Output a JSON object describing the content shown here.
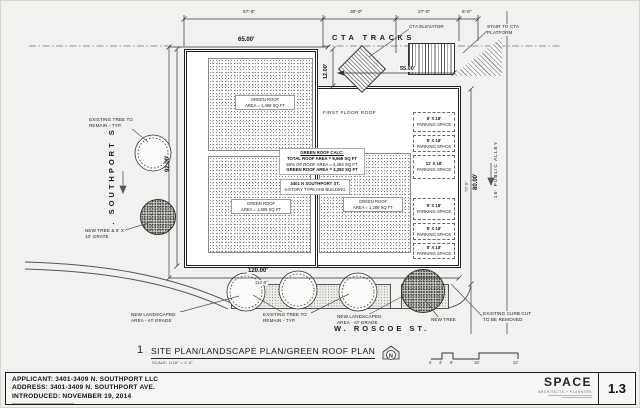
{
  "sheet_title": {
    "detail_number": "1",
    "title": "SITE PLAN/LANDSCAPE PLAN/GREEN ROOF PLAN",
    "scale_note": "SCALE: 1/16\" = 1'-0\""
  },
  "streets": {
    "west": "N. SOUTHPORT ST.",
    "south": "W. ROSCOE ST.",
    "alley": "16' PUBLIC ALLEY",
    "tracks": "CTA TRACKS"
  },
  "cta": {
    "elevator_label": "CTA ELEVATOR",
    "stair_label": "STAIR TO CTA PLATFORM"
  },
  "dimensions": {
    "top_segments": [
      "57'-6\"",
      "30'-0\"",
      "27'-0\"",
      "5'-0\""
    ],
    "building_north": "65.00'",
    "west": "92.00'",
    "east": "80.00'",
    "east_secondary": "72'-0\"",
    "south": "120.00'",
    "south_secondary": "114'-6\"",
    "notch": "12.00'",
    "cta": "55.00'"
  },
  "building": {
    "address": "3401 N SOUTHPORT ST.",
    "description": "4-STORY TYPE III-B BUILDING",
    "first_floor_roof": "FIRST FLOOR ROOF"
  },
  "green_roof": {
    "calc_title": "GREEN ROOF CALC:",
    "calc_lines": [
      "TOTAL ROOF AREA = 8,568 SQ FT",
      "50% OF ROOF AREA = 4,284 SQ FT",
      "GREEN ROOF AREA = 4,292 SQ FT"
    ],
    "areas": [
      {
        "name": "GREEN ROOF",
        "area": "AREA = 1,498 SQ FT"
      },
      {
        "name": "GREEN ROOF",
        "area": "AREA = 1,506 SQ FT"
      },
      {
        "name": "GREEN ROOF",
        "area": "AREA = 1,288 SQ FT"
      }
    ]
  },
  "parking": {
    "spaces": [
      {
        "size": "8' X 18'",
        "type": "PARKING SPACE"
      },
      {
        "size": "8' X 18'",
        "type": "PARKING SPACE"
      },
      {
        "size": "11' X 18'",
        "type": "PARKING SPACE"
      },
      {
        "size": "8' X 18'",
        "type": "PARKING SPACE"
      },
      {
        "size": "8' X 18'",
        "type": "PARKING SPACE"
      },
      {
        "size": "8' X 18'",
        "type": "PARKING SPACE"
      }
    ]
  },
  "landscape": {
    "existing_tree_west": "EXISTING TREE TO REMAIN - TYP.",
    "new_tree_grate": "NEW TREE & 5' X 10' GRATE",
    "new_landscaped_west": "NEW LANDSCAPED AREA - AT GRADE",
    "existing_tree_south": "EXISTING TREE TO REMAIN - TYP.",
    "new_landscaped_east": "NEW LANDSCAPED AREA - AT GRADE",
    "new_tree": "NEW TREE",
    "curb_cut": "EXISTING CURB CUT TO BE REMOVED"
  },
  "compass": {
    "north": "N"
  },
  "scale_bar": {
    "ticks": [
      "0",
      "4'",
      "8'",
      "16'",
      "32'"
    ]
  },
  "footer": {
    "applicant": "APPLICANT: 3401-3409 N. SOUTHPORT LLC",
    "address": "ADDRESS: 3401-3409 N. SOUTHPORT AVE.",
    "introduced": "INTRODUCED: NOVEMBER 19, 2014",
    "firm_name": "SPACE",
    "firm_tagline": "ARCHITECTS + PLANNERS",
    "sheet_number": "1.3"
  }
}
